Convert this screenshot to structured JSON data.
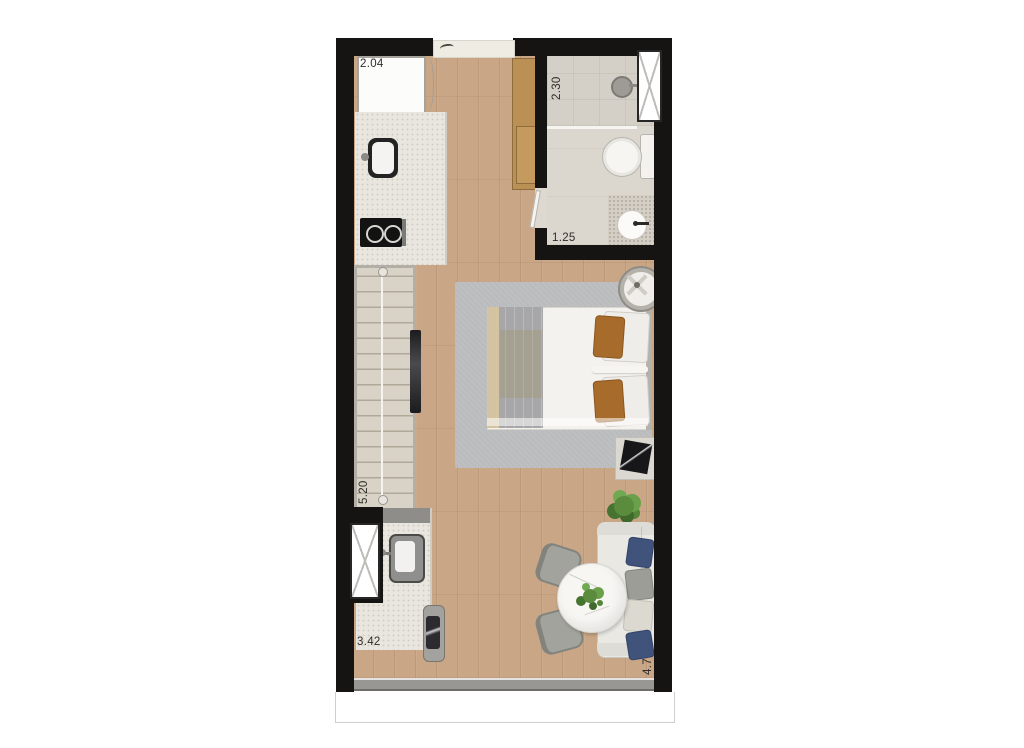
{
  "plan": {
    "type": "studio-apartment-floor-plan",
    "dimensions": {
      "kitchen": "2.04",
      "shower": "2.30",
      "bathroom": "1.25",
      "wardrobe_wall": "5.20",
      "laundry": "3.42",
      "living_wall": "4.7"
    },
    "rooms": [
      "kitchen",
      "bathroom",
      "living-sleeping-area",
      "laundry",
      "balcony"
    ],
    "furniture_symbols": [
      "refrigerator",
      "kitchen-sink",
      "cooktop",
      "tall-cabinet",
      "wardrobe",
      "tv-panel",
      "double-bed",
      "rug",
      "ceiling-fan",
      "nightstand",
      "plant",
      "sofa",
      "dining-table",
      "dining-chair",
      "laundry-sink",
      "washing-machine",
      "toilet",
      "shower-head",
      "bathroom-sink",
      "window",
      "entry-mat"
    ],
    "colors": {
      "wall": "#151413",
      "wood_floor": "#c9a685",
      "tile_floor": "#e9e6df",
      "rug": "#babbbd",
      "cabinet_wood": "#bb9055",
      "pillow_navy": "#40537a",
      "pillow_brown": "#a76c2b",
      "plant_green": "#5b8c3d"
    }
  }
}
